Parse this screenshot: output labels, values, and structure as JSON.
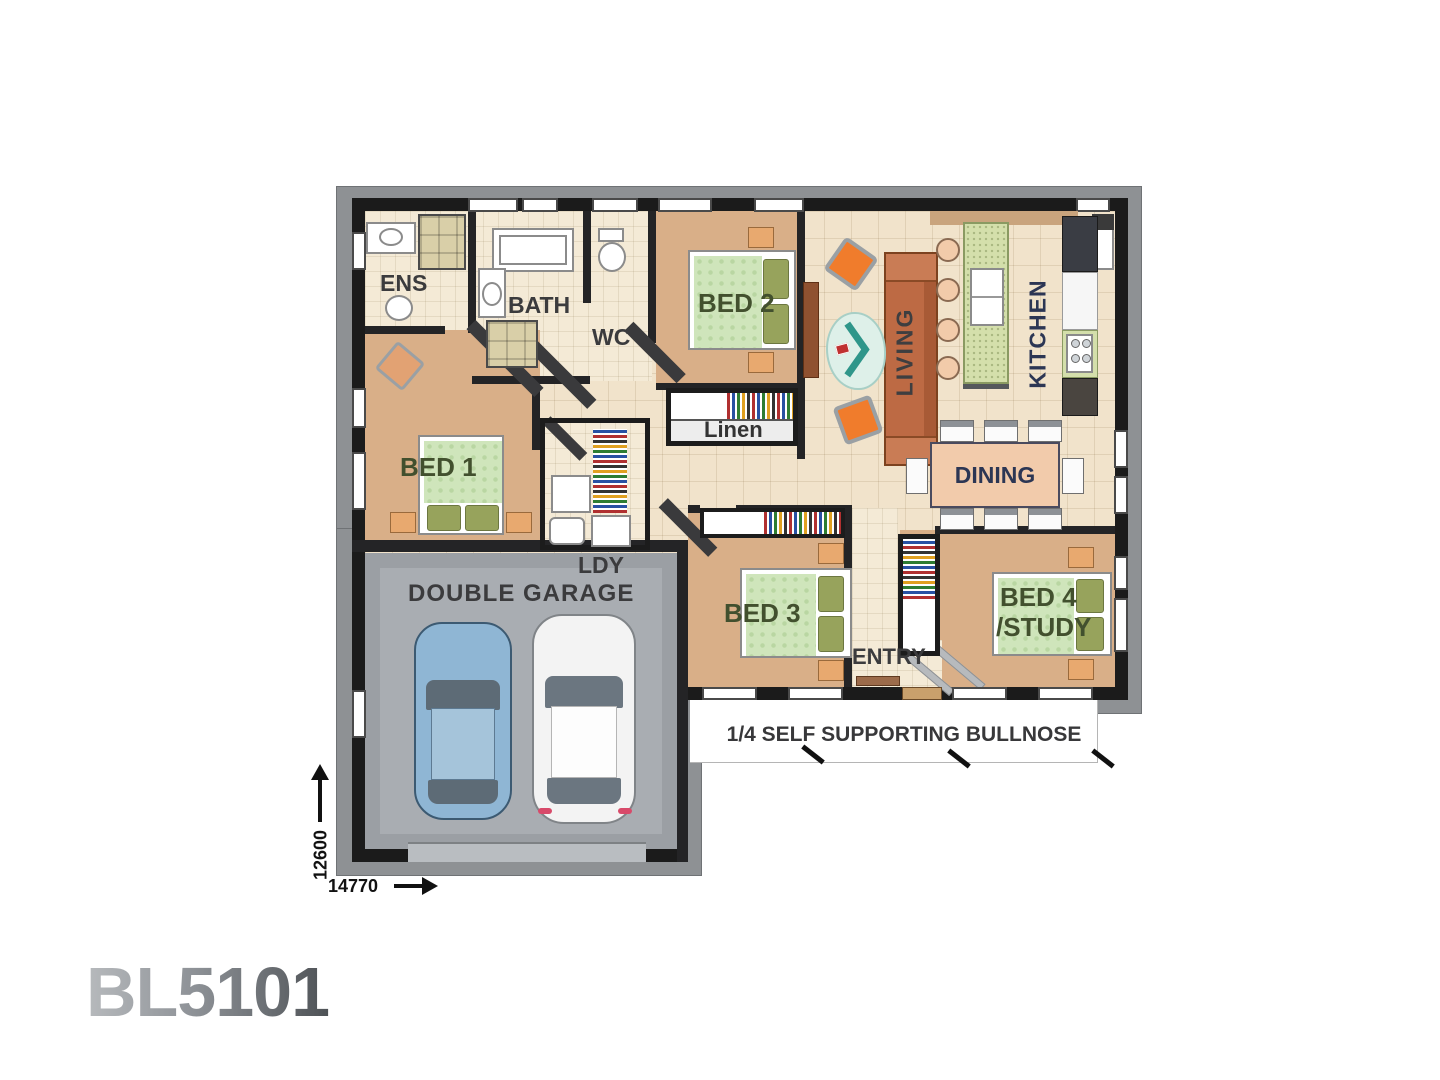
{
  "plan_code": "BL5101",
  "rooms": {
    "ens": "ENS",
    "bath": "BATH",
    "wc": "WC",
    "bed1": "BED 1",
    "bed2": "BED 2",
    "bed3": "BED 3",
    "bed4_line1": "BED 4",
    "bed4_line2": "/STUDY",
    "living": "LIVING",
    "kitchen": "KITCHEN",
    "dining": "DINING",
    "linen": "Linen",
    "laundry": "LDY",
    "garage": "DOUBLE GARAGE",
    "entry": "ENTRY"
  },
  "annotations": {
    "veranda": "1/4 SELF SUPPORTING BULLNOSE"
  },
  "dimensions": {
    "depth": "12600",
    "width": "14770"
  },
  "colors": {
    "wall": "#1b1b1b",
    "eave_gray": "#8e9194",
    "bedroom_floor": "#d9af88",
    "living_tile": "#f1e3cb",
    "wet_area_tile": "#f4ead6",
    "garage_floor": "#9b9fa4",
    "bed_spread_green": "#cfe5bb",
    "pillow_olive": "#97a35c",
    "side_table_orange": "#e8a96f",
    "sofa_terracotta": "#bd6a44",
    "ottoman_orange": "#f07c2c",
    "rug_teal": "#2f968a",
    "island_green": "#d4dfab",
    "dining_table_peach": "#f2cbab",
    "car_blue": "#8fb6d4",
    "car_white": "#f3f3f3",
    "label_dark": "#3b3b3d",
    "label_navy": "#2c3654",
    "bed_label_green": "#42502e"
  }
}
